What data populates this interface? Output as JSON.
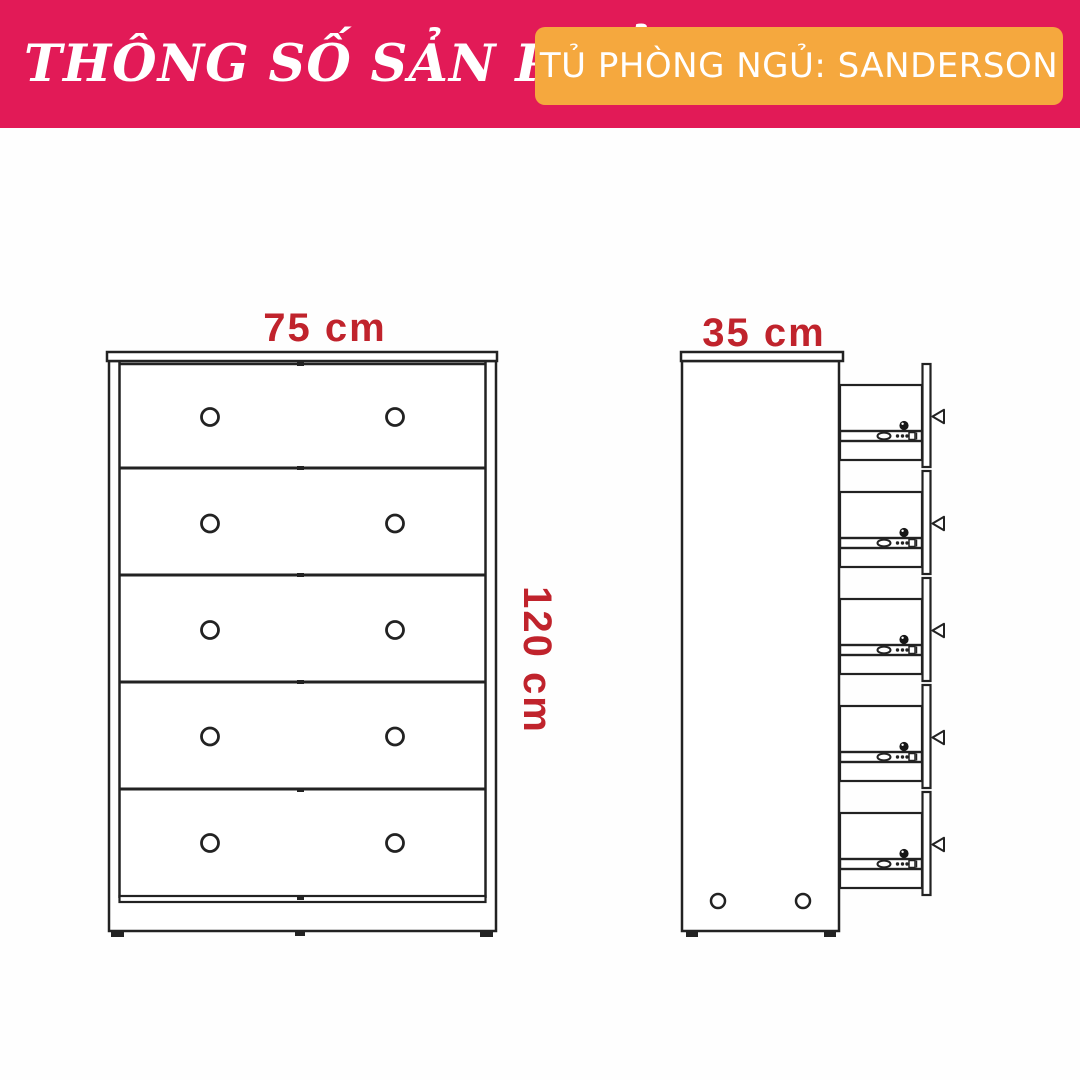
{
  "header": {
    "title": "THÔNG SỐ SẢN PHẨM",
    "product_label": "TỦ PHÒNG NGỦ: SANDERSON",
    "colors": {
      "band": "#E21A57",
      "badge": "#F5A83E",
      "text": "#FFFFFF"
    }
  },
  "diagram": {
    "colors": {
      "dimension_text": "#C0232C",
      "line": "#222222"
    },
    "front_view": {
      "label": "front-view",
      "width_label": "75 cm",
      "height_label": "120 cm",
      "drawer_count": 5,
      "knobs_per_drawer": 2
    },
    "side_view": {
      "label": "side-view",
      "depth_label": "35 cm",
      "drawer_count": 5,
      "bottom_hole_count": 2
    }
  }
}
